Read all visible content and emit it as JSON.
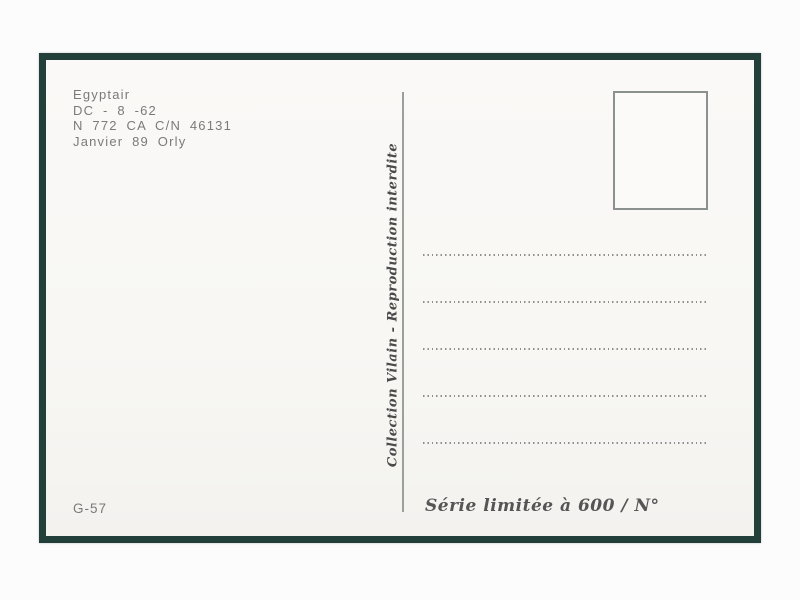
{
  "postcard": {
    "caption": {
      "line1": "Egyptair",
      "line2": "DC - 8 -62",
      "line3": "N 772 CA C/N 46131",
      "line4": "Janvier 89 Orly"
    },
    "publisher_credit": "Collection Vilain - Reproduction interdite",
    "catalog_number": "G-57",
    "edition_note": "Série limitée à 600 / N°",
    "address_lines_count": 5,
    "colors": {
      "frame_dark_green": "#223f3a",
      "card_offwhite": "#f9f8f5",
      "ink_gray": "#7a7a7a",
      "script_ink": "#4a4a4a",
      "rule_gray": "#9aa09d"
    }
  }
}
